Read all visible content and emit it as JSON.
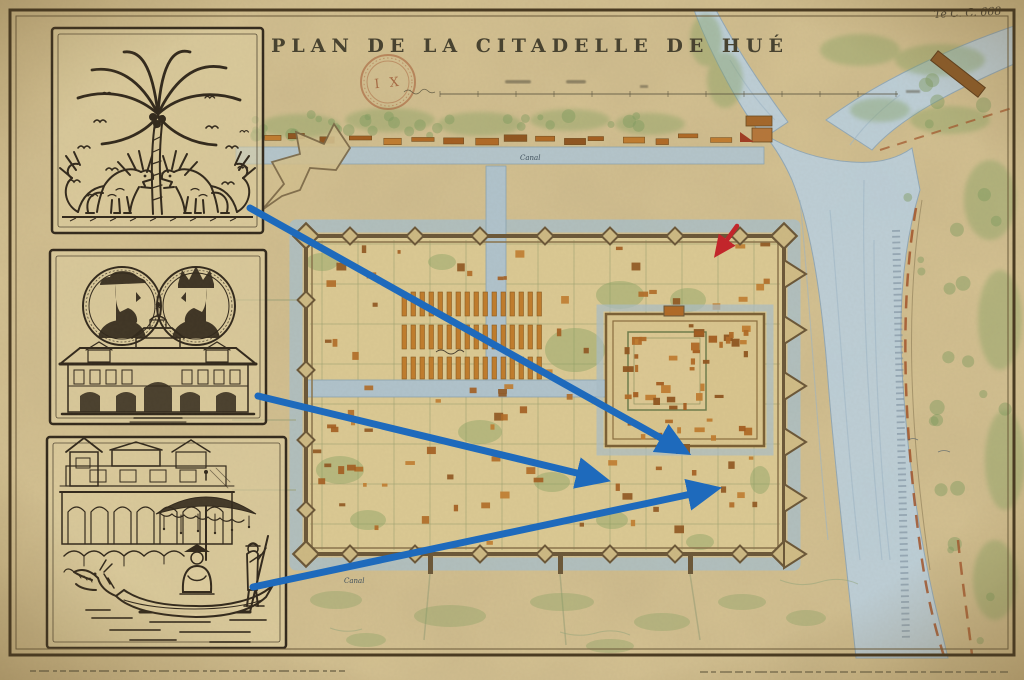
{
  "header": {
    "title": "PLAN DE LA CITADELLE DE HUÉ",
    "reference_code": "Te C. C. 668",
    "stamp_text": "I X"
  },
  "map": {
    "labels": {
      "canal_north": "Canal",
      "canal_south": "Canal"
    }
  },
  "panels": [
    {
      "name": "palm-and-guardian-lions",
      "description": "Ink drawing of a palm tree flanked by two guardian dragon-lion statues with flying birds"
    },
    {
      "name": "portrait-medallions-building",
      "description": "Two engraved portrait medallions of bearded men above a two-story colonial building"
    },
    {
      "name": "dragon-boat",
      "description": "Dragon boat with parasol canopy and two figures before an arcaded riverside building"
    }
  ],
  "annotations": {
    "arrow_color": "#1e6abc",
    "red_arrow_color": "#c2262b",
    "blue_arrows": [
      {
        "x1": 250,
        "y1": 208,
        "x2": 668,
        "y2": 442
      },
      {
        "x1": 258,
        "y1": 396,
        "x2": 585,
        "y2": 475
      },
      {
        "x1": 253,
        "y1": 587,
        "x2": 696,
        "y2": 493
      }
    ],
    "red_arrow": {
      "x1": 737,
      "y1": 226,
      "x2": 724,
      "y2": 244
    }
  },
  "colors": {
    "parchment": "#d5c292",
    "ink": "#32291c",
    "river": "#bccfda",
    "moat": "#a9bec8",
    "wall": "#6b5738",
    "building_orange": "#b06a26",
    "vegetation": "#82a05e",
    "frame": "#4a3b22",
    "blue_arrow": "#1e6abc",
    "red_arrow": "#c2262b"
  }
}
